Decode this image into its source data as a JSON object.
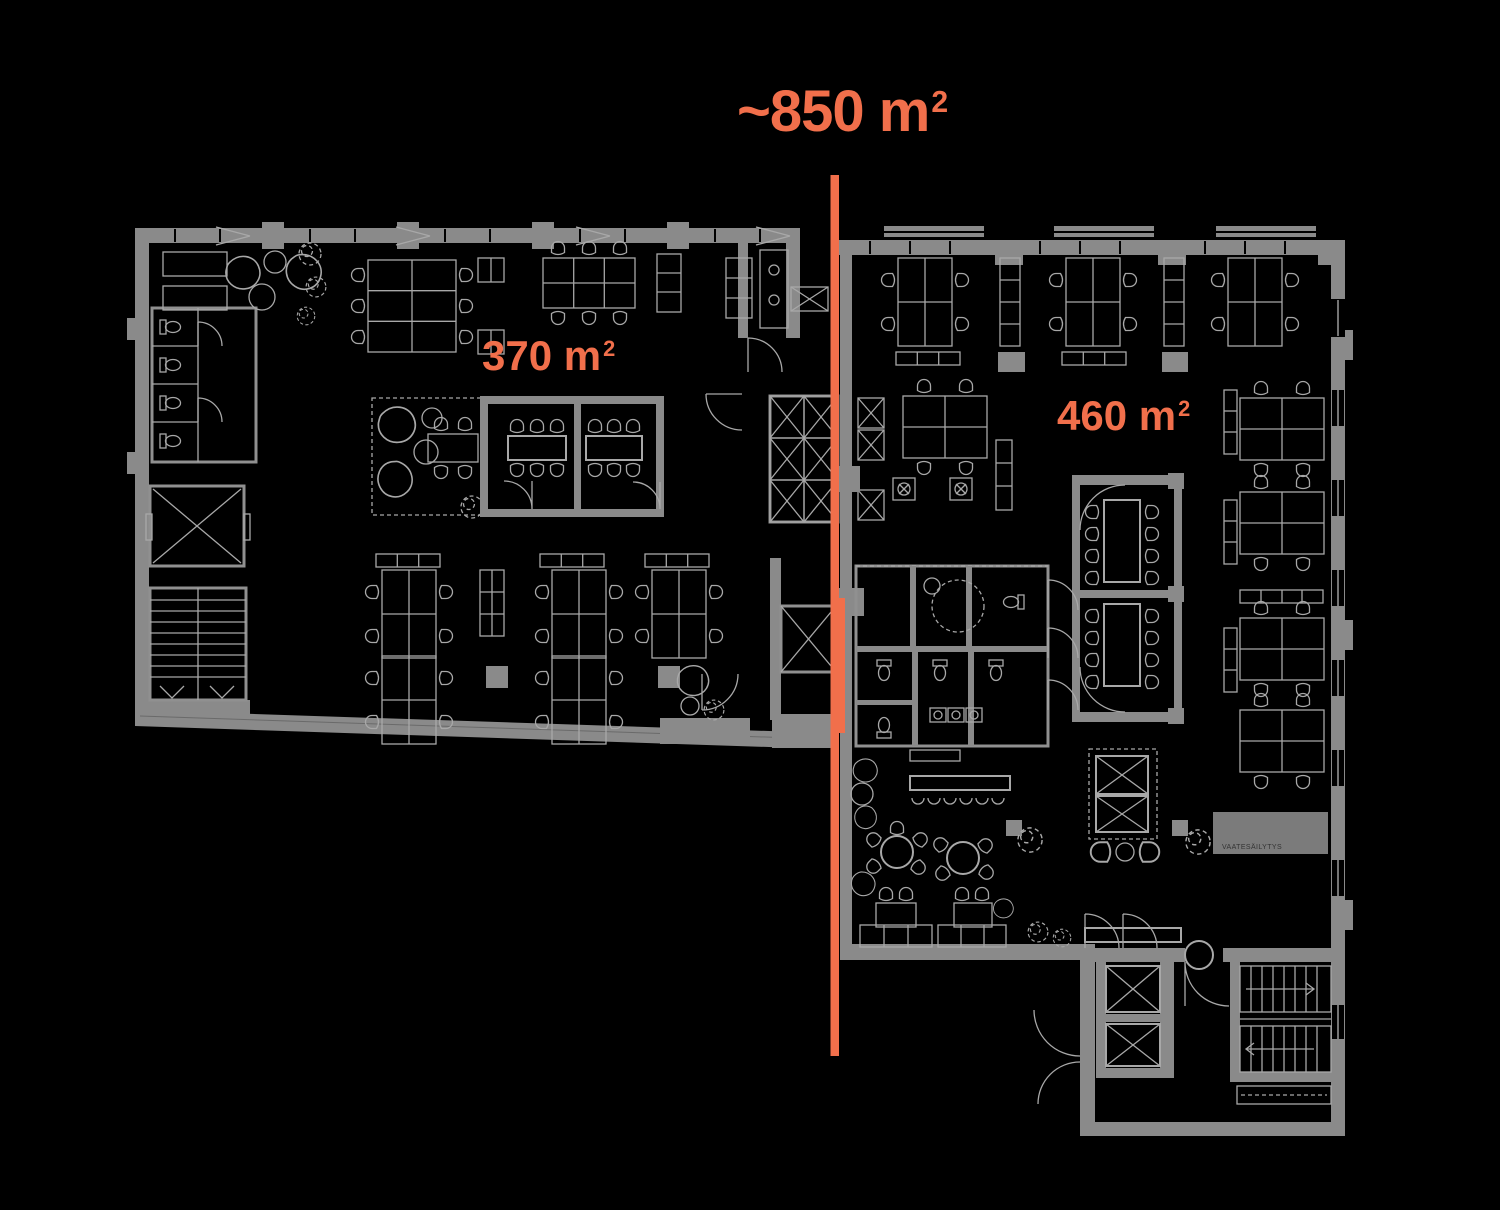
{
  "colors": {
    "background": "#000000",
    "accent": "#F16F4B",
    "wall": "#8A8A8A",
    "line": "#A8A8A8"
  },
  "title": {
    "value": "~850 m",
    "sup": "2"
  },
  "zones": {
    "left": {
      "label": "370 m",
      "sup": "2"
    },
    "right": {
      "label": "460 m",
      "sup": "2"
    }
  },
  "plan_text": {
    "wardrobe": "VAATESÄILYTYS"
  }
}
